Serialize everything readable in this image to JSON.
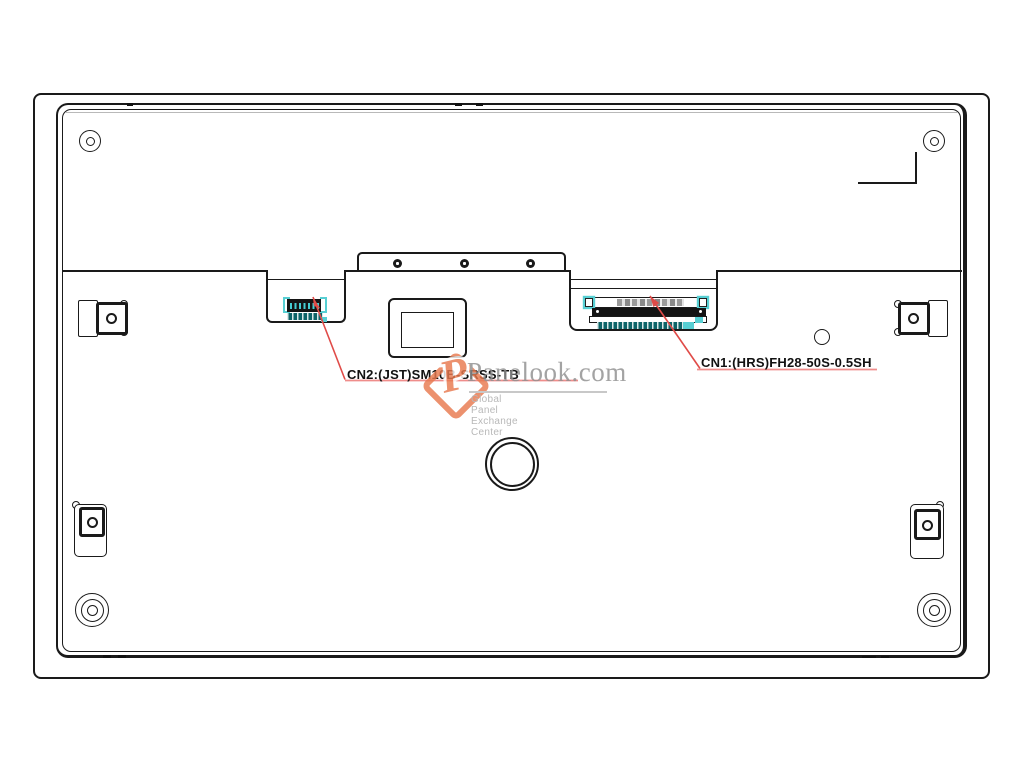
{
  "annotations": {
    "cn2_label": "CN2:(JST)SM10B-SRSS-TB",
    "cn1_label": "CN1:(HRS)FH28-50S-0.5SH"
  },
  "watermark": {
    "brand": "Panelook.com",
    "tagline": "Global Panel Exchange Center",
    "logo_letter": "P"
  },
  "colors": {
    "line": "#1a1a1a",
    "annotation_red": "#e04b48",
    "underline_red": "#ef8d8b",
    "highlight_teal": "#57cfd3",
    "connector_teal_dark": "#0e6468",
    "watermark_gray": "#8f8f8f",
    "watermark_light_gray": "#a9a9a9",
    "logo_orange": "#e8794f"
  }
}
